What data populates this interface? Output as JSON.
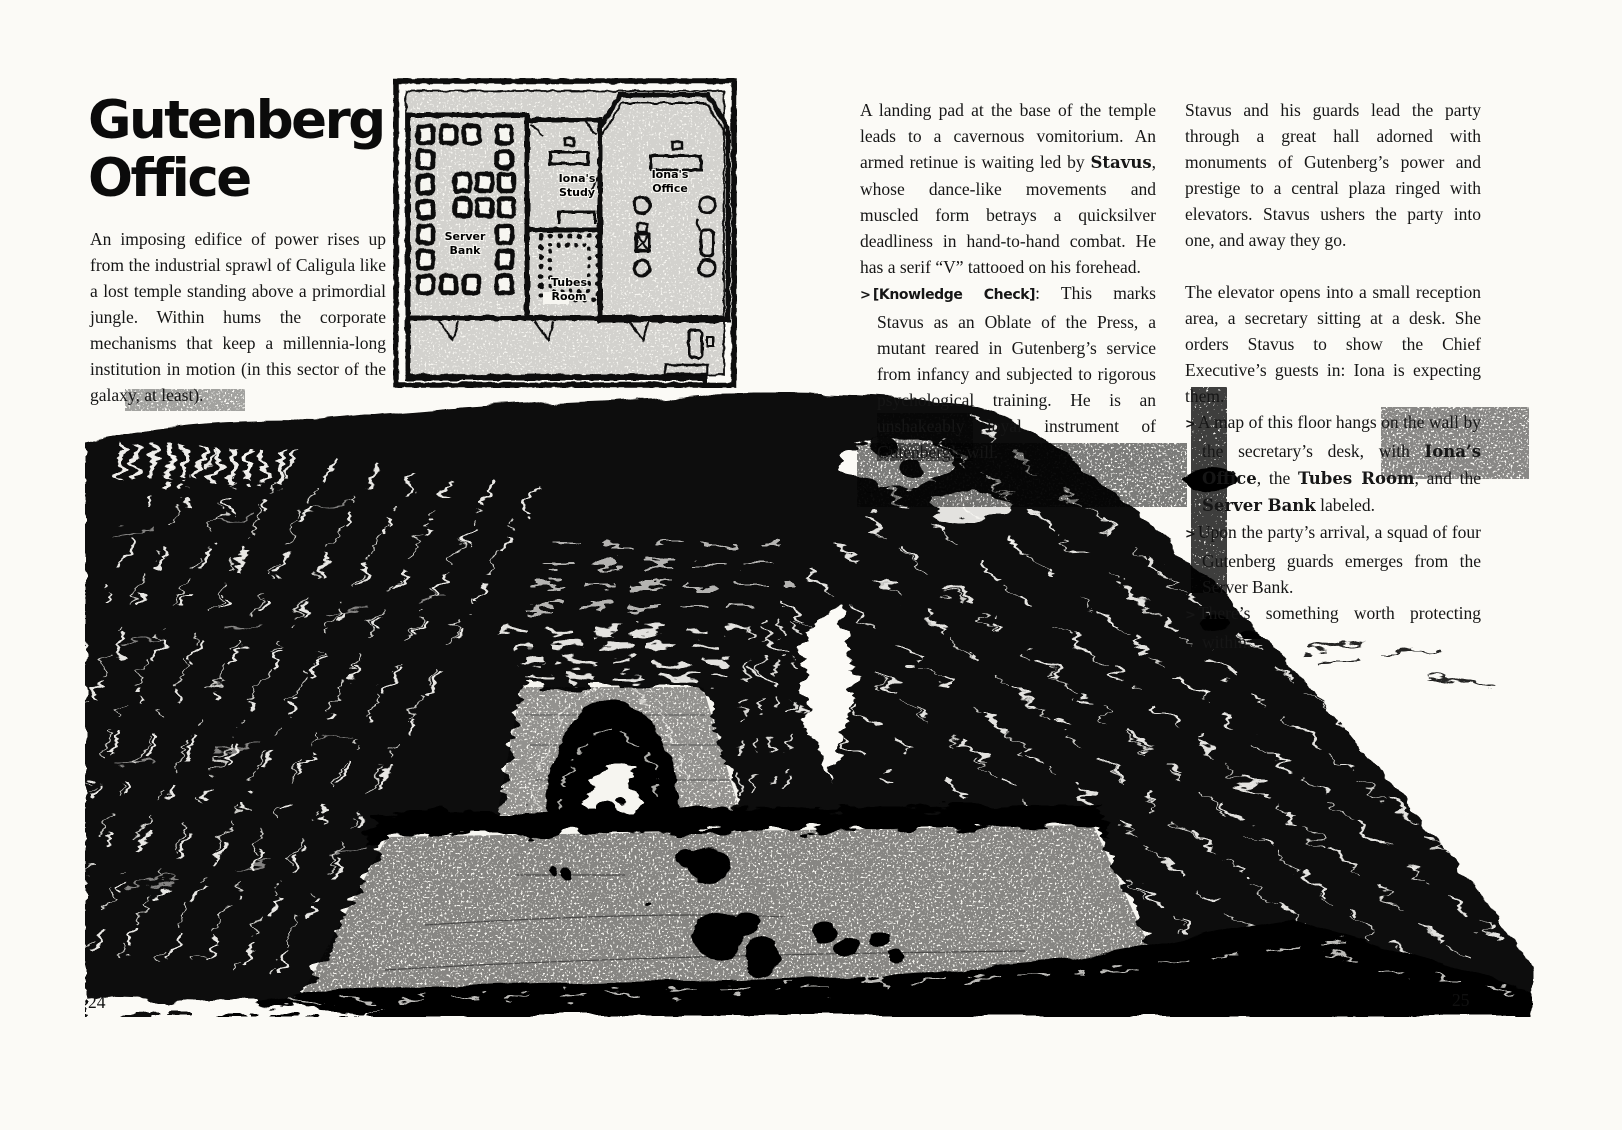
{
  "left_page": {
    "page_number": "24",
    "title1": "Gutenberg",
    "title2": "Office",
    "intro": "An imposing edifice of power rises up from the industrial sprawl of Caligula like a lost temple standing above a primordial jungle. Within hums the corporate mechanisms that keep a millennia-long institution in motion (in this sector of the galaxy, at least).",
    "map": {
      "server1": "Server",
      "server2": "Bank",
      "study1": "Iona's",
      "study2": "Study",
      "tubes1": "Tubes",
      "tubes2": "Room",
      "office1": "Iona's",
      "office2": "Office"
    }
  },
  "right_page": {
    "page_number": "25",
    "col1": {
      "p1a": "A landing pad at the base of the temple leads to a cavernous vomitorium. An armed retinue is waiting led by ",
      "p1b": "Stavus",
      "p1c": ", whose dance-like movements and muscled form betrays a quicksilver deadliness in hand-to-hand combat. He has a serif “V” tattooed on his forehead.",
      "kc_marker": ">",
      "kc_label": "[Knowledge Check]",
      "kc_text": ": This marks Stavus as an Oblate of the Press, a mutant reared in Gutenberg’s service from infancy and subjected to rigorous psychological training. He is an unshakeably loyal instrument of Gutenberg’s will."
    },
    "col2": {
      "p1": "Stavus and his guards lead the party through a great hall adorned with monuments of Gutenberg’s power and prestige to a central plaza ringed with elevators. Stavus ushers the party into one, and away they go.",
      "p2": "The elevator opens into a small reception area, a secretary sitting at a desk. She orders Stavus to show the Chief Executive’s guests in: Iona is expecting them.",
      "b1_marker": ">",
      "b1a": "A map of this floor hangs on the wall by the secretary’s desk, with ",
      "b1b": "Iona’s Office",
      "b1c": ", the ",
      "b1d": "Tubes Room",
      "b1e": ", and the ",
      "b1f": "Server Bank",
      "b1g": " labeled.",
      "b2_marker": ">",
      "b2": "Upon the party’s arrival, a squad of four Gutenberg guards emerges from the Server Bank.",
      "b3_marker": ">",
      "b3": "There’s something worth protecting within."
    }
  }
}
